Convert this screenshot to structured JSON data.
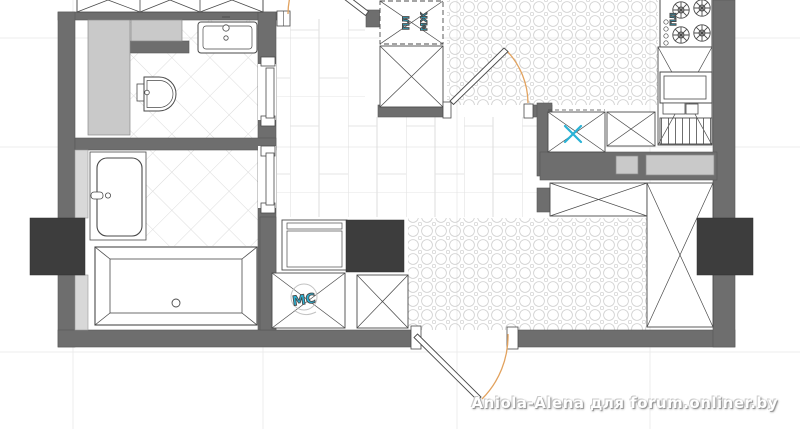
{
  "watermark": {
    "text": "Aniola-Alena для forum.onliner.by"
  },
  "annotations": {
    "washer_label": "МС",
    "closet_label_1": "ПЛ",
    "closet_label_2": "МЖ",
    "stove_label": "ПЛ"
  },
  "colors": {
    "wall_gray": "#6e6e6e",
    "dark_block": "#3d3d3d",
    "shaft_gray": "#c9c9c9",
    "lining_gray": "#d8d8d8",
    "pattern_line": "#d9d9d9",
    "fixture_stroke": "#4a4a4a",
    "annotation_cyan": "#2ab3d6",
    "door_arc_orange": "#e2a25e",
    "grid_line": "#ececec",
    "watermark_white": "#ffffff"
  }
}
